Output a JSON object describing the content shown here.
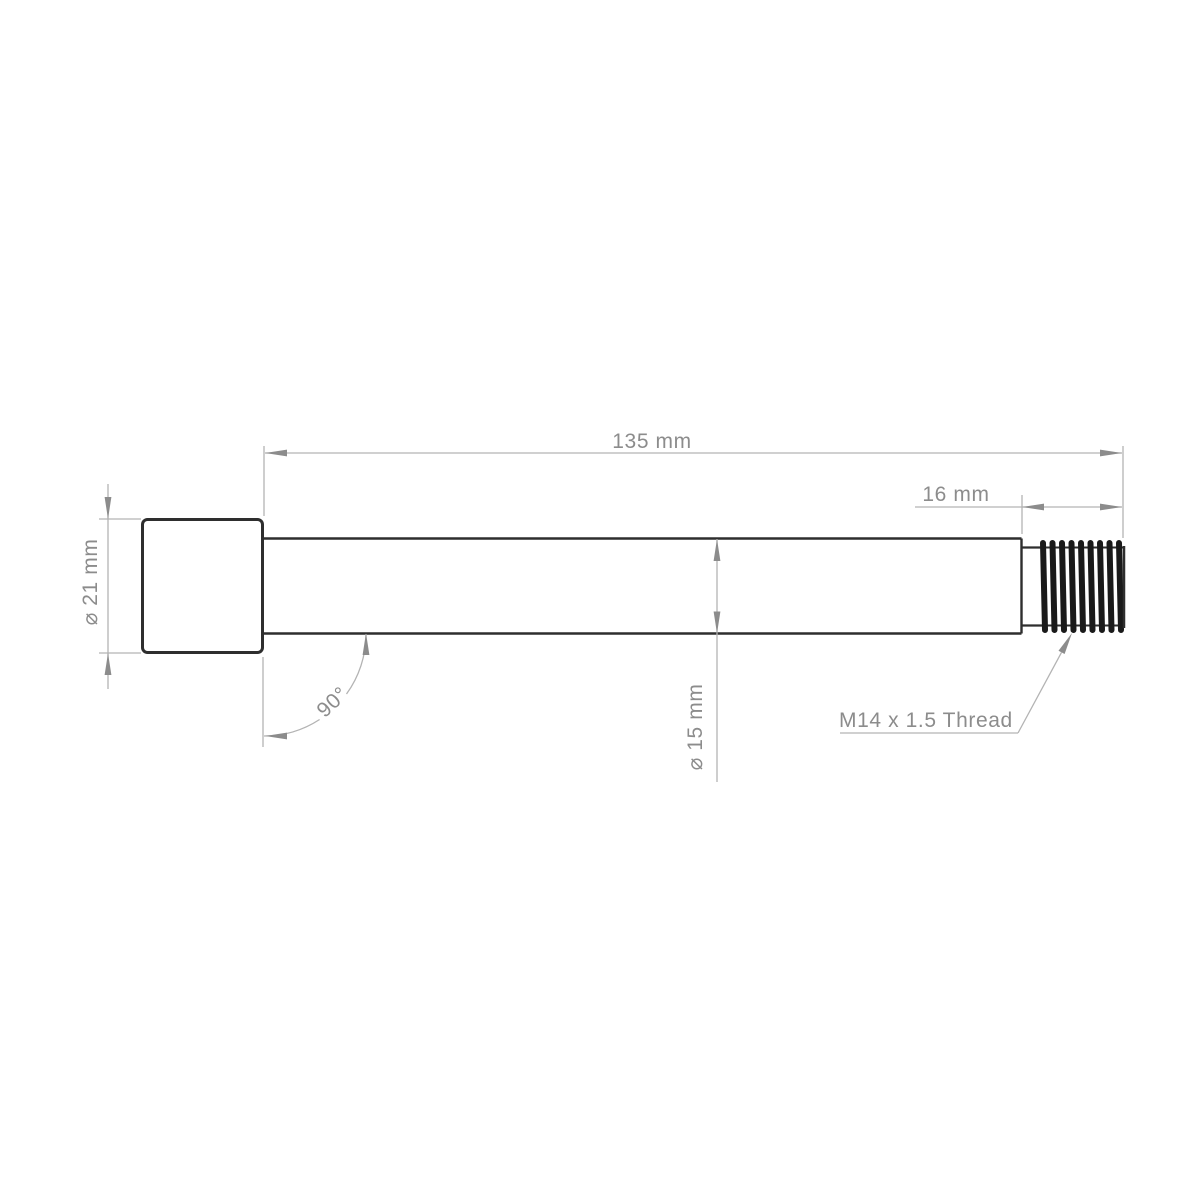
{
  "drawing": {
    "description": "Axle technical drawing with dimensions",
    "labels": {
      "total_length": "135 mm",
      "thread_length": "16 mm",
      "head_diameter": "⌀ 21 mm",
      "shaft_diameter": "⌀ 15 mm",
      "head_angle": "90°",
      "thread_spec": "M14 x 1.5 Thread"
    },
    "colors": {
      "background": "#ffffff",
      "part_line": "#2e2e2e",
      "thread_dark": "#1a1a1a",
      "dimension_line": "#b3b3b3",
      "dimension_arrow": "#8c8c8c",
      "dimension_text": "#8c8c8c"
    }
  }
}
